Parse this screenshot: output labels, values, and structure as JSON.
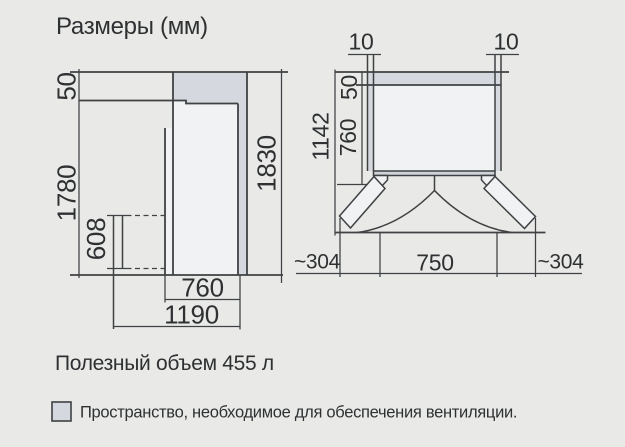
{
  "title": "Размеры (мм)",
  "side_view": {
    "dim_top_gap": "50",
    "dim_height": "1780",
    "dim_total_height": "1830",
    "dim_bottom": "608",
    "dim_depth": "760",
    "dim_depth_open": "1190"
  },
  "top_view": {
    "dim_gap_left": "10",
    "dim_gap_right": "10",
    "dim_total_depth": "1142",
    "dim_rear_gap": "50",
    "dim_depth": "760",
    "dim_side_left": "~304",
    "dim_front": "750",
    "dim_side_right": "~304"
  },
  "volume_note": "Полезный объем 455 л",
  "legend": {
    "text": "Пространство, необходимое для обеспечения вентиляции."
  },
  "colors": {
    "background": "#e9eae8",
    "line": "#3f4143",
    "text": "#2e3032",
    "ventilation_fill": "#d5d8df",
    "body_fill": "#f1f2f3"
  }
}
